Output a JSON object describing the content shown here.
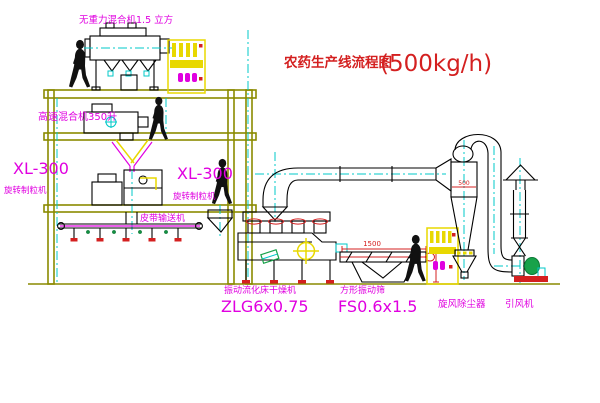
{
  "title": {
    "name": "农药生产线流程图",
    "capacity": "(500kg/h)"
  },
  "labels": {
    "gravity_mixer": "无重力混合机1.5 立方",
    "high_speed_mixer": "高速混合机350升",
    "granulator_left_model": "XL-300",
    "granulator_left_name": "旋转制粒机",
    "granulator_right_model": "XL-300",
    "granulator_right_name": "旋转制粒机",
    "belt_conveyor": "皮带输送机",
    "dryer_name": "振动流化床干燥机",
    "dryer_model": "ZLG6x0.75",
    "sieve_name": "方形振动筛",
    "sieve_model": "FS0.6x1.5",
    "cyclone": "旋风除尘器",
    "fan": "引风机"
  },
  "dimensions": {
    "sieve_length": "1500",
    "cyclone_diameter": "500"
  },
  "colors": {
    "label_magenta": "#e000e0",
    "title_red": "#d42020",
    "structure_olive": "#8a8a00",
    "centerline_cyan": "#00c8c8",
    "cabinet_yellow": "#e8d800",
    "motor_green": "#18a24a",
    "equipment_black": "#000000"
  }
}
